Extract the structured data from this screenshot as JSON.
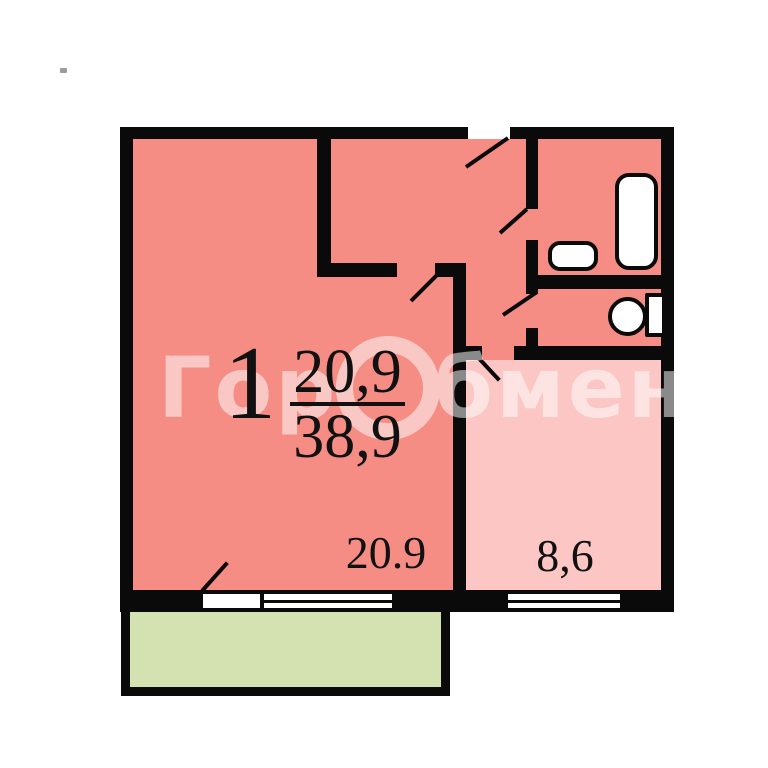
{
  "watermark": {
    "prefix": "Гор",
    "suffix": "бмен"
  },
  "labels": {
    "room_number": "1",
    "total_area_numerator": "20,9",
    "total_area_denominator": "38,9",
    "living_area": "20.9",
    "kitchen_area": "8,6"
  },
  "colors": {
    "wall": "#0a0a0a",
    "room": "#f68d85",
    "kitchen": "#fbc6c4",
    "balcony": "#d4e2b2",
    "fixture": "#ffffff",
    "watermark": "#ffffff",
    "label": "#111111",
    "background": "#ffffff"
  }
}
